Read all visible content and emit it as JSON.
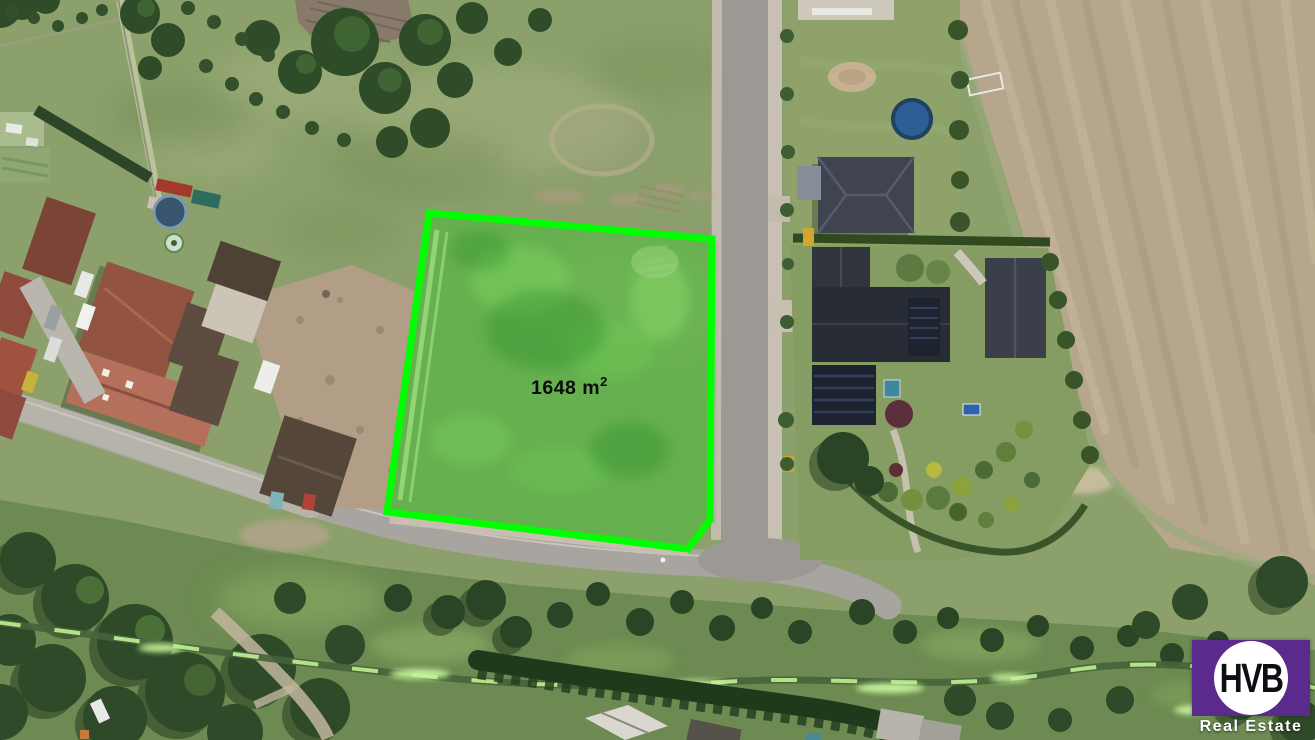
{
  "image": {
    "kind": "aerial-property-photo",
    "width_px": 1315,
    "height_px": 740
  },
  "plot": {
    "area_label": "1648 m",
    "area_superscript": "2",
    "outline_color": "#00FF00",
    "fill_tint": "#44BF35"
  },
  "logo": {
    "monogram": "HVB",
    "tagline": "Real Estate",
    "square_color": "#5A2B8C",
    "circle_color": "#FFFFFF",
    "monogram_color": "#0E0E14",
    "tagline_color": "#FFFFFF"
  },
  "palette": {
    "grass": "#8BA06B",
    "meadow": "#6C8A51",
    "plowed_field": "#B6A78C",
    "road": "#A8A5A0",
    "street": "#9C9995",
    "tree": "#2E4C28"
  }
}
